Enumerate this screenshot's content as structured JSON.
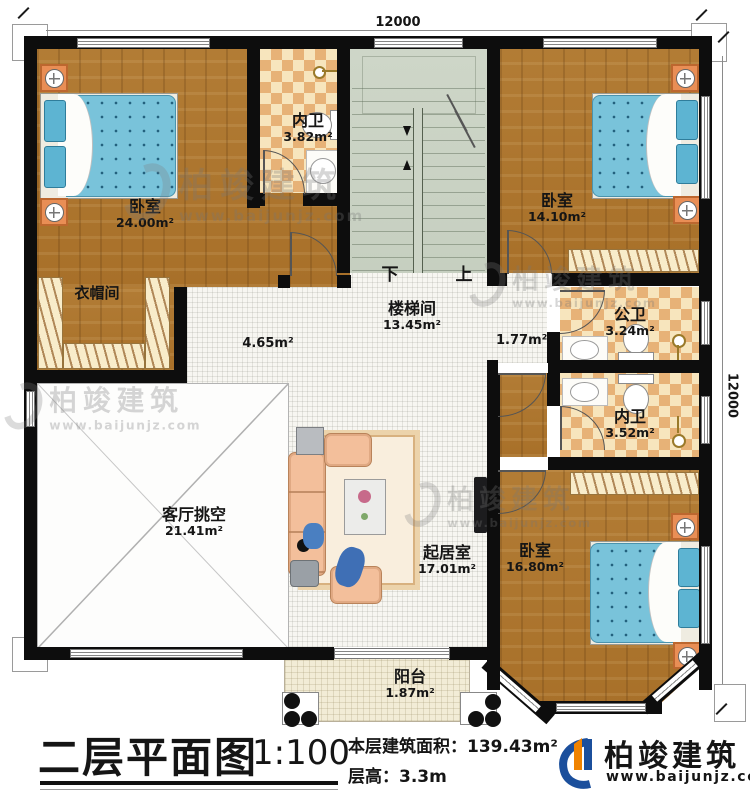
{
  "dimensions": {
    "top": "12000",
    "right": "12000"
  },
  "rooms": {
    "bedroom1": {
      "name": "卧室",
      "area": "24.00m²"
    },
    "bath1": {
      "name": "内卫",
      "area": "3.82m²"
    },
    "cloak": {
      "name": "衣帽间"
    },
    "stair": {
      "name": "楼梯间",
      "area": "13.45m²",
      "down": "下",
      "up": "上"
    },
    "bedroom2": {
      "name": "卧室",
      "area": "14.10m²"
    },
    "hall1": {
      "area": "4.65m²"
    },
    "hall2": {
      "area": "1.77m²"
    },
    "bath2": {
      "name": "公卫",
      "area": "3.24m²"
    },
    "bath3": {
      "name": "内卫",
      "area": "3.52m²"
    },
    "void": {
      "name": "客厅挑空",
      "area": "21.41m²"
    },
    "living": {
      "name": "起居室",
      "area": "17.01m²"
    },
    "bedroom3": {
      "name": "卧室",
      "area": "16.80m²"
    },
    "balcony": {
      "name": "阳台",
      "area": "1.87m²"
    }
  },
  "title": {
    "name": "二层平面图",
    "scale": "1:100",
    "area_label": "本层建筑面积：",
    "area_value": "139.43m²",
    "floor_height_label": "层高：",
    "floor_height_value": "3.3m"
  },
  "brand": {
    "name": "柏竣建筑",
    "url": "www.baijunjz.com"
  },
  "watermark": {
    "name": "柏竣建筑",
    "url": "www.baijunjz.com"
  },
  "colors": {
    "wall": "#0d0d0d",
    "wood": "#b07a33",
    "tile_checker": "#e7b277",
    "stair": "#ccd4c6",
    "bed_blue": "#79c3da",
    "nightstand": "#e98e55",
    "sofa": "#f3bf9b",
    "brand_blue": "#1b4f9c",
    "brand_orange": "#f08300"
  }
}
